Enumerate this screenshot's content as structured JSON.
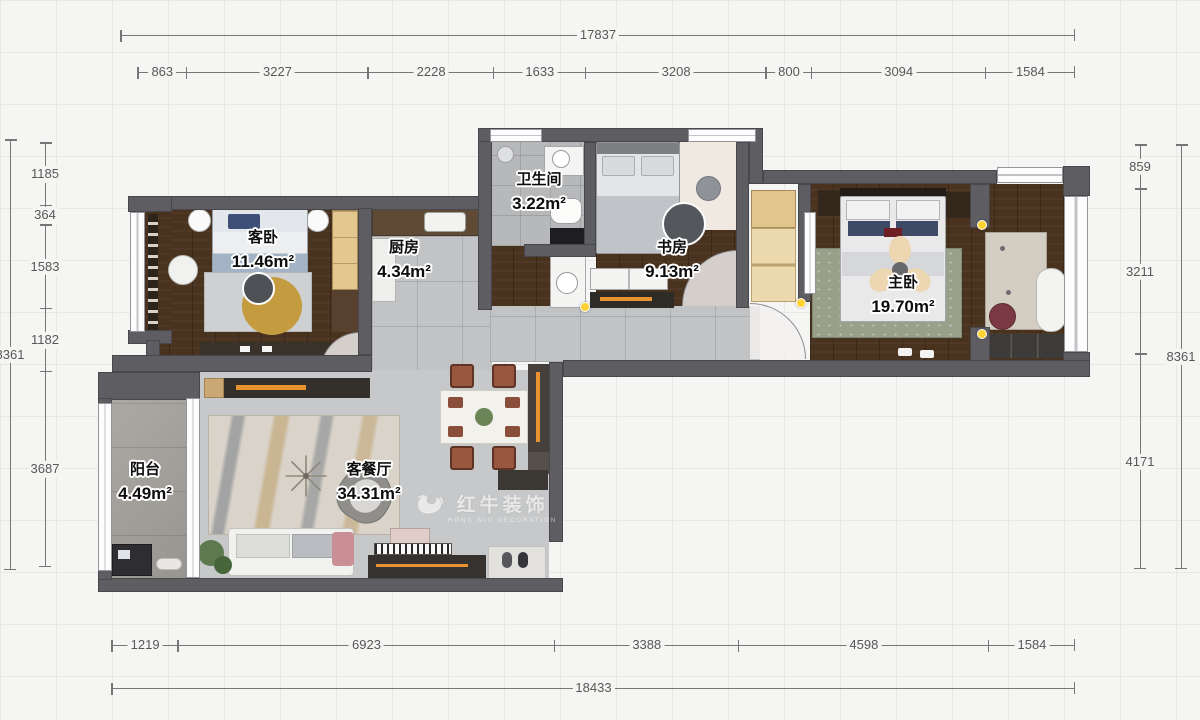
{
  "rooms": {
    "guest_bedroom": {
      "name": "客卧",
      "area": "11.46m²"
    },
    "kitchen": {
      "name": "厨房",
      "area": "4.34m²"
    },
    "bathroom": {
      "name": "卫生间",
      "area": "3.22m²"
    },
    "study": {
      "name": "书房",
      "area": "9.13m²"
    },
    "master_bedroom": {
      "name": "主卧",
      "area": "19.70m²"
    },
    "balcony": {
      "name": "阳台",
      "area": "4.49m²"
    },
    "living_dining": {
      "name": "客餐厅",
      "area": "34.31m²"
    }
  },
  "dimensions": {
    "top_total": "17837",
    "top_segments": [
      "863",
      "3227",
      "2228",
      "1633",
      "3208",
      "800",
      "3094",
      "1584"
    ],
    "bottom_segments": [
      "1219",
      "6923",
      "3388",
      "4598",
      "1584"
    ],
    "bottom_total": "18433",
    "left_segments": [
      "1185",
      "364",
      "1583",
      "1182",
      "3687"
    ],
    "left_total": "8361",
    "right_segments": [
      "859",
      "3211",
      "4171"
    ],
    "right_total": "8361"
  },
  "watermark": {
    "brand": "红牛装饰",
    "tagline": "HONG NIU DECORATION"
  },
  "colors": {
    "wall": "#5d5d62",
    "wood_floor": "#49331f",
    "tile": "#c2c3c4",
    "accent_orange": "#e8932f",
    "marker_yellow": "#ffd234"
  }
}
